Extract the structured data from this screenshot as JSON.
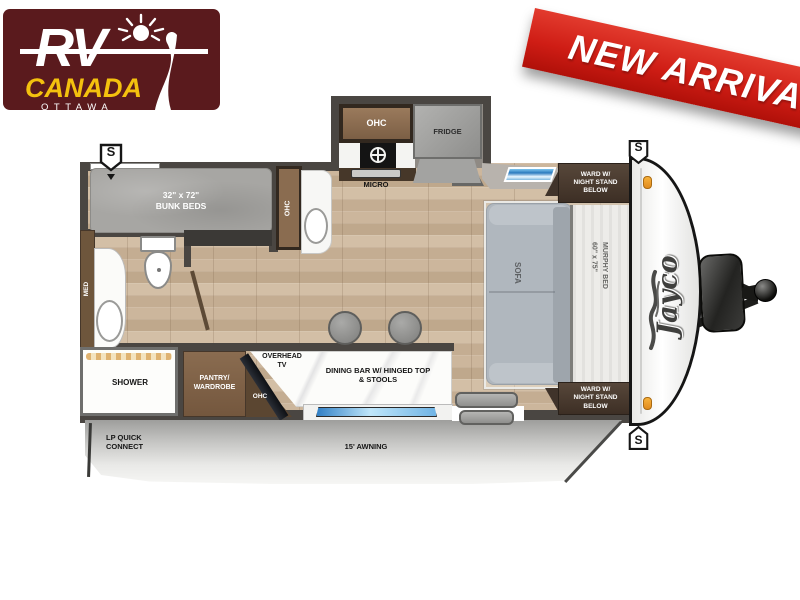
{
  "logo": {
    "rv": "RV",
    "canada": "CANADA",
    "ottawa": "OTTAWA"
  },
  "banner": {
    "label": "NEW ARRIVAL"
  },
  "floorplan": {
    "bunk_beds": {
      "line1": "32\" x 72\"",
      "line2": "BUNK BEDS"
    },
    "ohc": "OHC",
    "fridge": "FRIDGE",
    "micro": "MICRO",
    "med": "MED",
    "shower": "SHOWER",
    "pantry": {
      "line1": "PANTRY/",
      "line2": "WARDROBE"
    },
    "overhead_tv": {
      "line1": "OVERHEAD",
      "line2": "TV"
    },
    "dining_bar": {
      "line1": "DINING BAR W/ HINGED TOP",
      "line2": "& STOOLS"
    },
    "sofa": "SOFA",
    "murphy_bed": {
      "line1": "60\" x 75\"",
      "line2": "MURPHY BED"
    },
    "wardrobe": {
      "line1": "WARD W/",
      "line2": "NIGHT STAND",
      "line3": "BELOW"
    },
    "speaker": "S",
    "jayco": "Jayco",
    "lp_quick_connect": {
      "line1": "LP QUICK",
      "line2": "CONNECT"
    },
    "awning": "15' AWNING"
  },
  "colors": {
    "brand_maroon": "#5a1a1d",
    "brand_yellow": "#f4c10e",
    "banner_red": "#cf1d15",
    "wall": "#4a4642",
    "wood_floor": "#c8b197",
    "window_blue": "#2f7ec4",
    "cabinet_wood": "#8a6c50",
    "ward_brown": "#4a3a2e",
    "sofa_gray": "#959ea9"
  }
}
